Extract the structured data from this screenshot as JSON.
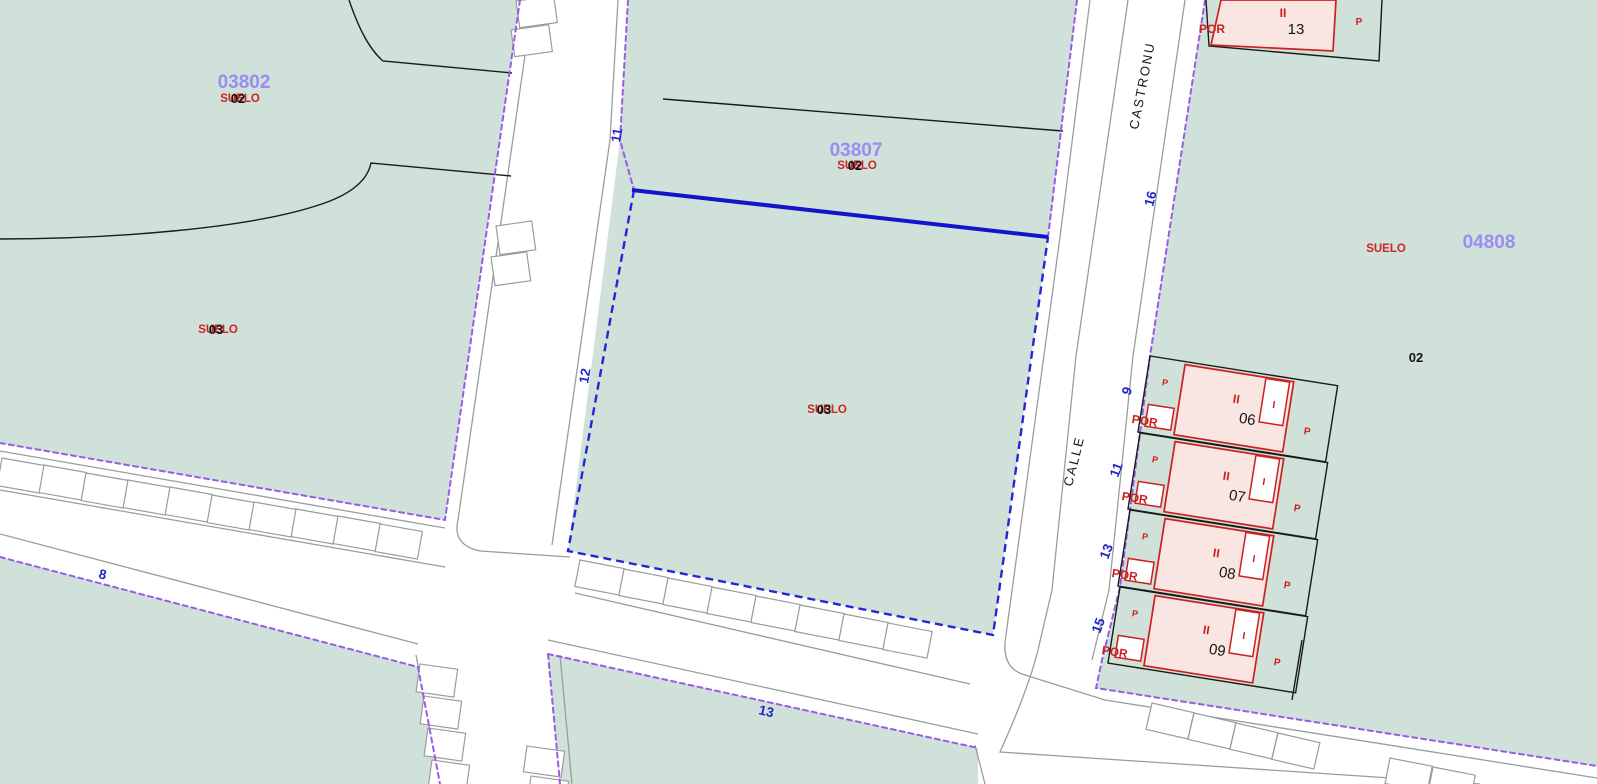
{
  "colors": {
    "parcel_fill": "#cfe1d8",
    "boundary_purple": "#9a5ce4",
    "selected_parcel_blue": "#1414cc",
    "parcel_code_purple": "#9a8cf2",
    "land_use_red": "#cc2424",
    "street_number_blue": "#2424cc",
    "building_fill": "#f9e5e2",
    "building_outline_red": "#cc1f1f",
    "curb_gray": "#9c9c9c",
    "line_black": "#1a1a1a"
  },
  "parcels": {
    "p03802": {
      "code": "03802",
      "land": "SUELO",
      "sub_a": "02",
      "land_b": "SUELO",
      "sub_b": "03"
    },
    "p03807": {
      "code": "03807",
      "land": "SUELO",
      "sub": "02"
    },
    "selected": {
      "land": "SUELO",
      "sub": "03"
    },
    "p04808": {
      "code": "04808",
      "land": "SUELO",
      "sub": "02"
    }
  },
  "streets": {
    "name_segment_upper": "CASTRONU",
    "name_segment_lower": "CALLE",
    "numbers": {
      "left_top": "11",
      "left_mid": "12",
      "bottom_left": "8",
      "bottom_center": "13",
      "right_top": "16",
      "right_h06": "9",
      "right_h07": "11",
      "right_h08": "13",
      "right_h09": "15"
    }
  },
  "buildings": {
    "b13": {
      "portal": "POR",
      "floors": "II",
      "number": "13",
      "courtyard": "P"
    },
    "h06": {
      "front": "P",
      "portal": "POR",
      "floors": "II",
      "number": "06",
      "stair": "I",
      "courtyard": "P"
    },
    "h07": {
      "front": "P",
      "portal": "POR",
      "floors": "II",
      "number": "07",
      "stair": "I",
      "courtyard": "P"
    },
    "h08": {
      "front": "P",
      "portal": "POR",
      "floors": "II",
      "number": "08",
      "stair": "I",
      "courtyard": "P"
    },
    "h09": {
      "front": "P",
      "portal": "POR",
      "floors": "II",
      "number": "09",
      "stair": "I",
      "courtyard": "P"
    }
  }
}
